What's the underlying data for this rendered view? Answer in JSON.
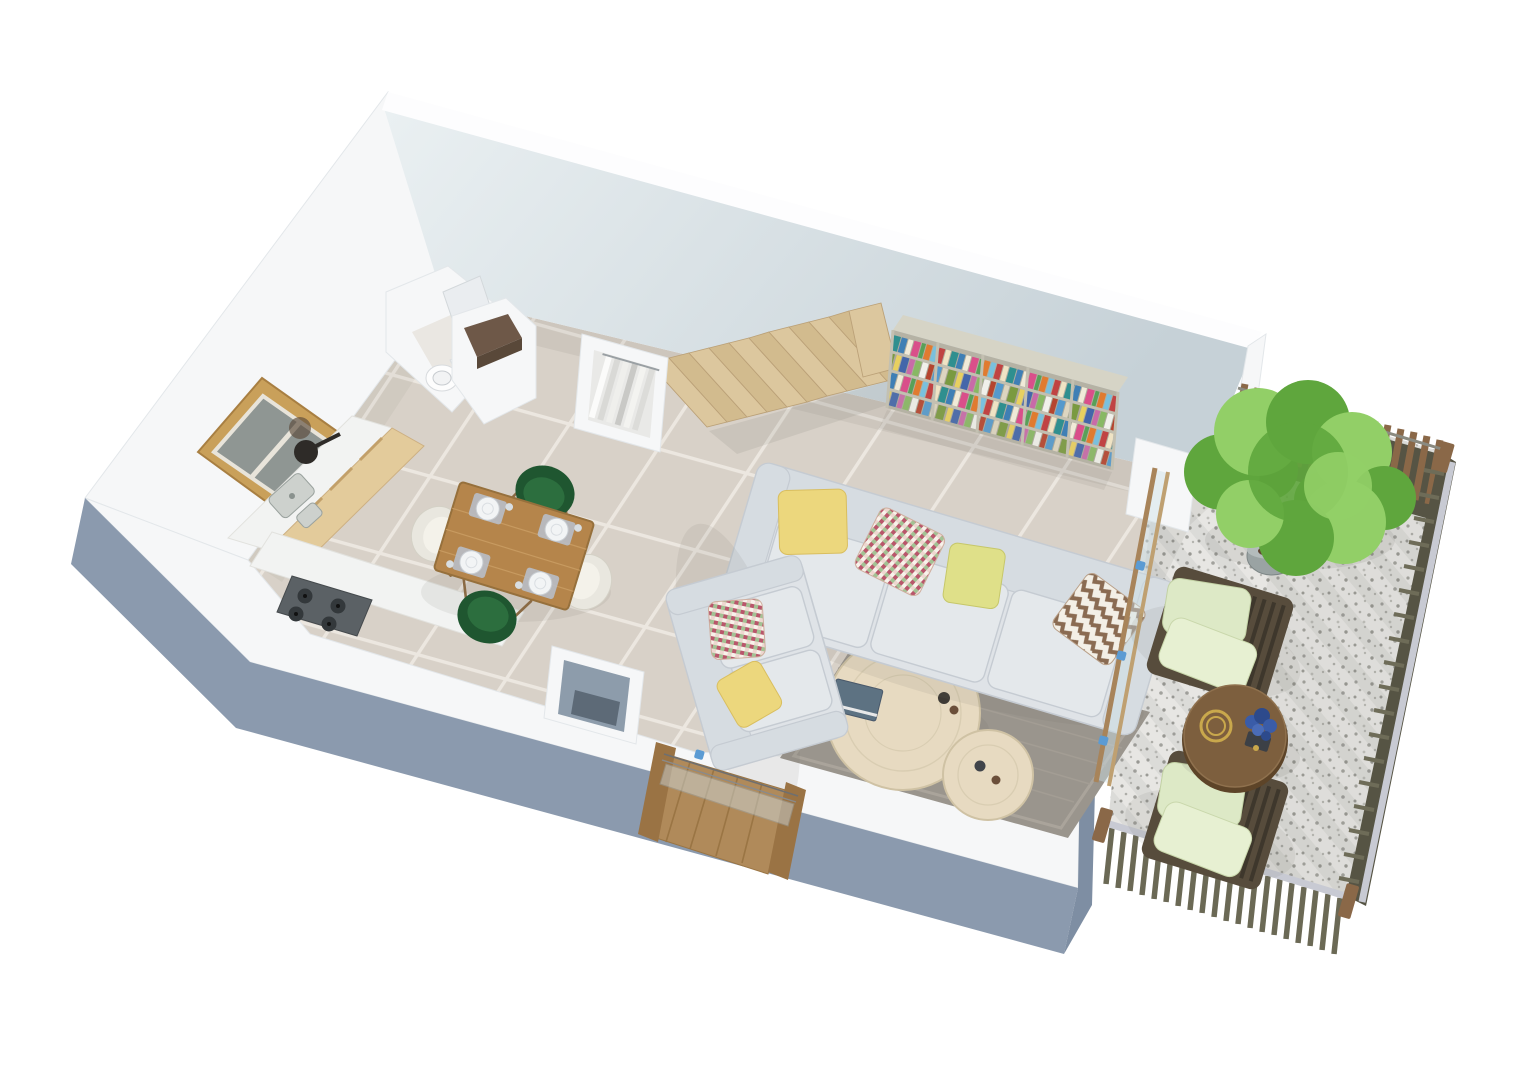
{
  "scene": {
    "type": "3d-floor-plan-render",
    "view": "isometric dollhouse cutaway, white background, no text",
    "rooms": [
      {
        "name": "kitchen",
        "objects": [
          "wood-framed-window",
          "counter-with-double-sink",
          "frying-pan",
          "wood-cabinet-fronts",
          "gas-cooktop"
        ]
      },
      {
        "name": "bathroom",
        "objects": [
          "toilet",
          "door-panel"
        ]
      },
      {
        "name": "entry-storage",
        "objects": [
          "storage-box-brown-interior",
          "open-wardrobe-with-hanging-clothes",
          "utility-shaft"
        ]
      },
      {
        "name": "living-dining",
        "objects": [
          "wood-staircase",
          "bookshelf-with-colorful-books",
          "dining-table-4-place-settings",
          "2-green-chairs",
          "2-white-chairs",
          "three-seat-sofa",
          "two-seat-sofa",
          "gray-rug",
          "2-round-coffee-tables",
          "front-door-open",
          "sliding-glass-door"
        ]
      },
      {
        "name": "terrace",
        "objects": [
          "gravel-floor-raked",
          "wood-slat-fence",
          "slat-railing-with-gray-handrail",
          "potted-tree",
          "2-lounge-chairs-green-cushions",
          "round-drum-side-table"
        ]
      }
    ],
    "counts": {
      "stair_steps": 10,
      "bookshelf_columns": 5,
      "bookshelf_rows": 4,
      "dining_seats": 4,
      "sofa_pillows": 6,
      "lounge_chairs": 2,
      "dining_plates": 4,
      "sliding_door_handles": 3
    }
  },
  "colors": {
    "background": "#ffffff",
    "wall_white": "#f6f7f8",
    "wall_top": "#fdfdfe",
    "wall_stroke": "#e3e7ea",
    "wall_face_light": "#eaf0f2",
    "wall_face_shade": "#c6d1d7",
    "wall_exterior_blue": "#8b9aae",
    "wall_exterior_blue_dark": "#7e8ea3",
    "floor_tile": "#d8d1c8",
    "floor_grout": "#ece7e0",
    "shadow": "#6b6b66",
    "stairs_wood": "#dcc79e",
    "stairs_wood_dark": "#d2bb8e",
    "stairs_edge": "#bba178",
    "bookshelf_top": "#d6d4c6",
    "bookshelf_frame": "#b5b2a4",
    "bookshelf_divider": "#c3c0b1",
    "dining_table_wood": "#b5854b",
    "dining_table_edge": "#96703c",
    "placemat": "#b8bdc4",
    "plate": "#f2f4f5",
    "chair_green": "#1f5630",
    "chair_green_seat": "#2c6e3e",
    "chair_white": "#e9e7df",
    "chair_white_seat": "#f4f2ea",
    "chair_leg": "#8a6a44",
    "sofa_fabric": "#dfe3e7",
    "sofa_back": "#d6dce1",
    "sofa_cushion": "#e4e8eb",
    "sofa_stroke": "#c5cbd2",
    "pillow_yellow": "#ecd77d",
    "pillow_green": "#dfe089",
    "rug": "#9a958d",
    "rug_border": "#aaa49b",
    "coffee_table_wood": "#e7dac1",
    "coffee_table_edge": "#cfc2a4",
    "book_cover": "#5d7282",
    "door_wood": "#b08a5a",
    "door_frame": "#9a7344",
    "glass": "#cfdfe6",
    "handle_blue": "#5b9bd3",
    "kitchen_wood": "#e3cb9b",
    "counter_white": "#f2f3f2",
    "sink_gray": "#cdd1cd",
    "cooktop": "#5b6165",
    "burner": "#33383b",
    "window_frame": "#c9a05a",
    "window_glass": "#8f9693",
    "toilet_white": "#fdfdfd",
    "wardrobe_interior": "#e9e9e7",
    "storage_brown": "#6e5848",
    "duct_blue": "#8d9cab",
    "terrace_gravel": "#e7e6e3",
    "gravel_dot": "#a2a29d",
    "fence_wood": "#8a6848",
    "fence_dark": "#565444",
    "railing_rail": "#c8cad3",
    "railing_slat": "#6b6955",
    "lounge_frame": "#574c3c",
    "lounge_slat": "#3e372c",
    "cushion_green": "#dde9c6",
    "cushion_green_light": "#e7f0d2",
    "drum_table": "#7d5f3e",
    "drum_edge": "#5d4428",
    "gold": "#c9a84c",
    "plant_green": "#5fa63d",
    "plant_green_light": "#92cf67",
    "plant_green_dark": "#47882f",
    "pot_gray": "#9aa3a3",
    "soil": "#5f4432",
    "flower_blue": "#3a5ca8"
  }
}
